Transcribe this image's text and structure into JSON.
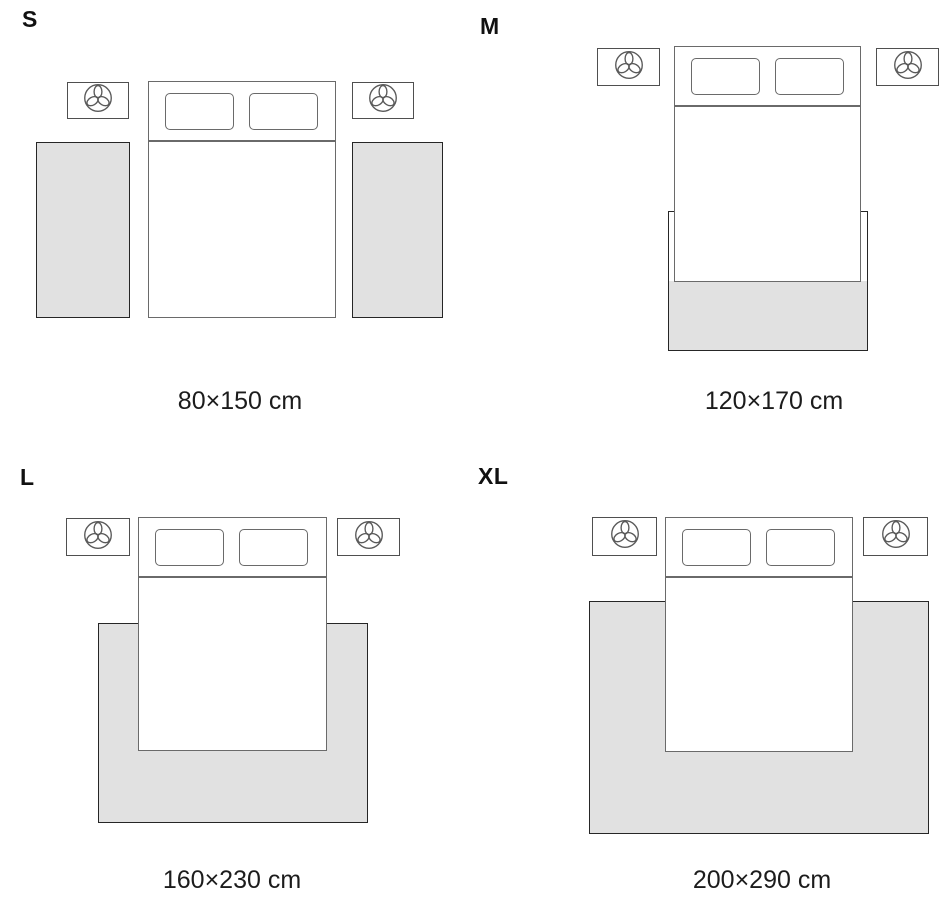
{
  "page": {
    "title": "Rug size guide"
  },
  "colors": {
    "background": "#ffffff",
    "rug_fill": "#e1e1e1",
    "rug_border": "#262626",
    "furniture_stroke": "#6a6a6a",
    "nightstand_stroke": "#4f4f4f",
    "text": "#111111"
  },
  "icons": {
    "nightstand_icon": "plant-icon"
  },
  "panels": [
    {
      "label": "S",
      "dimensions": "80×150 cm"
    },
    {
      "label": "M",
      "dimensions": "120×170 cm"
    },
    {
      "label": "L",
      "dimensions": "160×230 cm"
    },
    {
      "label": "XL",
      "dimensions": "200×290 cm"
    }
  ]
}
